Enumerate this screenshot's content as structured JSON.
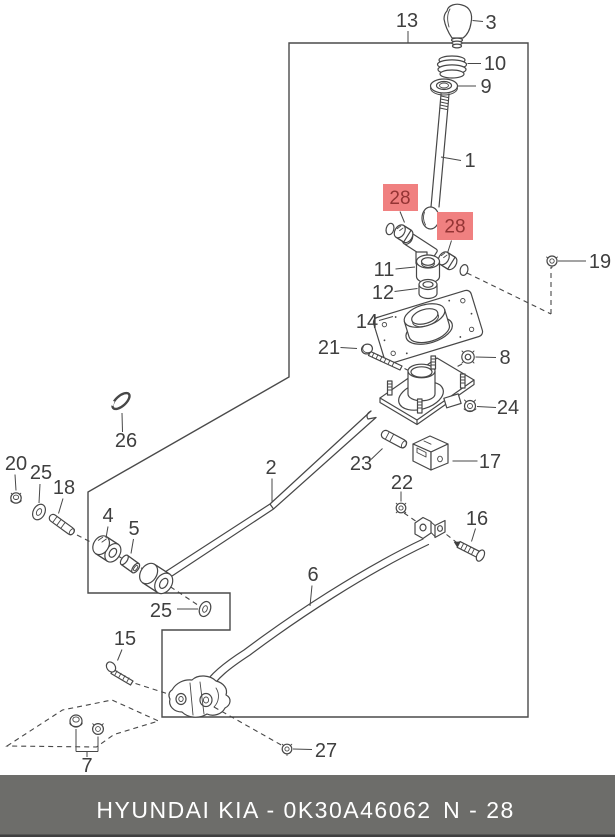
{
  "labels": {
    "p1": "1",
    "p2": "2",
    "p3": "3",
    "p4": "4",
    "p5": "5",
    "p6": "6",
    "p7": "7",
    "p8": "8",
    "p9": "9",
    "p10": "10",
    "p11": "11",
    "p12": "12",
    "p13": "13",
    "p14": "14",
    "p15": "15",
    "p16": "16",
    "p17": "17",
    "p18": "18",
    "p19": "19",
    "p20": "20",
    "p21": "21",
    "p22": "22",
    "p23": "23",
    "p24": "24",
    "p25a": "25",
    "p25b": "25",
    "p26": "26",
    "p27": "27",
    "p28a": "28",
    "p28b": "28"
  },
  "colors": {
    "highlight_bg": "#f08080",
    "highlight_text": "#943434",
    "footer_bg": "#6d6d6a",
    "footer_text": "#ffffff",
    "line": "#474747"
  },
  "footer": {
    "brand": "HYUNDAI  KIA - 0K30A46062",
    "page": "N - 28"
  }
}
